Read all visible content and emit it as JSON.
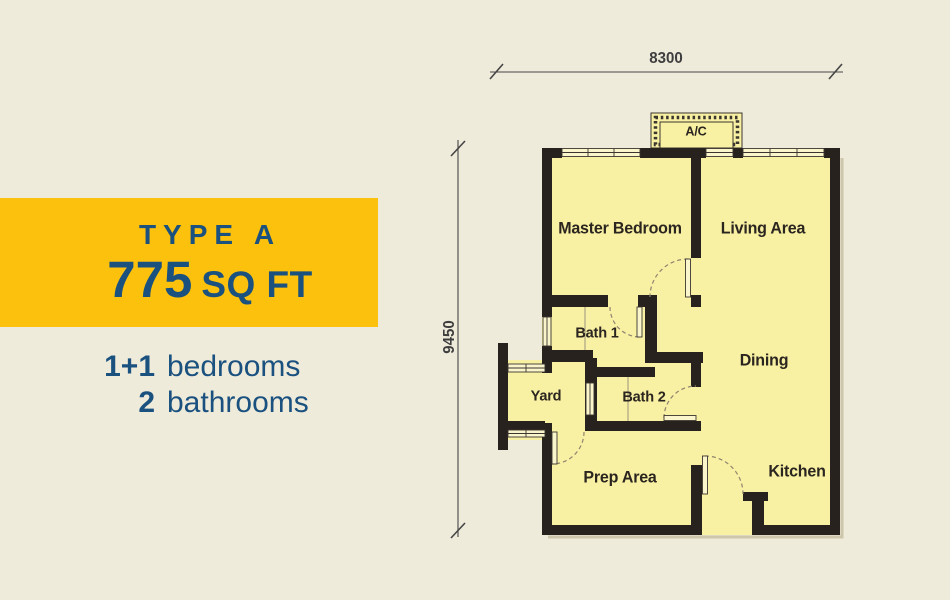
{
  "colors": {
    "page_background": "#EFEBDB",
    "banner_background": "#FCC10D",
    "text_blue": "#1A517F",
    "room_fill": "#F8F0A2",
    "wall": "#27221E",
    "window_fill": "#FBF5CB",
    "room_label": "#2B2520",
    "dimension_text": "#3E3E3E"
  },
  "info_panel": {
    "banner": {
      "title": "TYPE A",
      "area_value": "775",
      "area_unit": "SQ FT"
    },
    "specs": [
      {
        "count": "1+1",
        "label": "bedrooms"
      },
      {
        "count": "2",
        "label": "bathrooms"
      }
    ]
  },
  "floor_plan": {
    "dimension_width": "8300",
    "dimension_height": "9450",
    "rooms": [
      {
        "id": "ac",
        "label": "A/C"
      },
      {
        "id": "master-bedroom",
        "label": "Master Bedroom"
      },
      {
        "id": "living-area",
        "label": "Living Area"
      },
      {
        "id": "bath-1",
        "label": "Bath 1"
      },
      {
        "id": "dining",
        "label": "Dining"
      },
      {
        "id": "yard",
        "label": "Yard"
      },
      {
        "id": "bath-2",
        "label": "Bath 2"
      },
      {
        "id": "prep-area",
        "label": "Prep Area"
      },
      {
        "id": "kitchen",
        "label": "Kitchen"
      }
    ]
  }
}
